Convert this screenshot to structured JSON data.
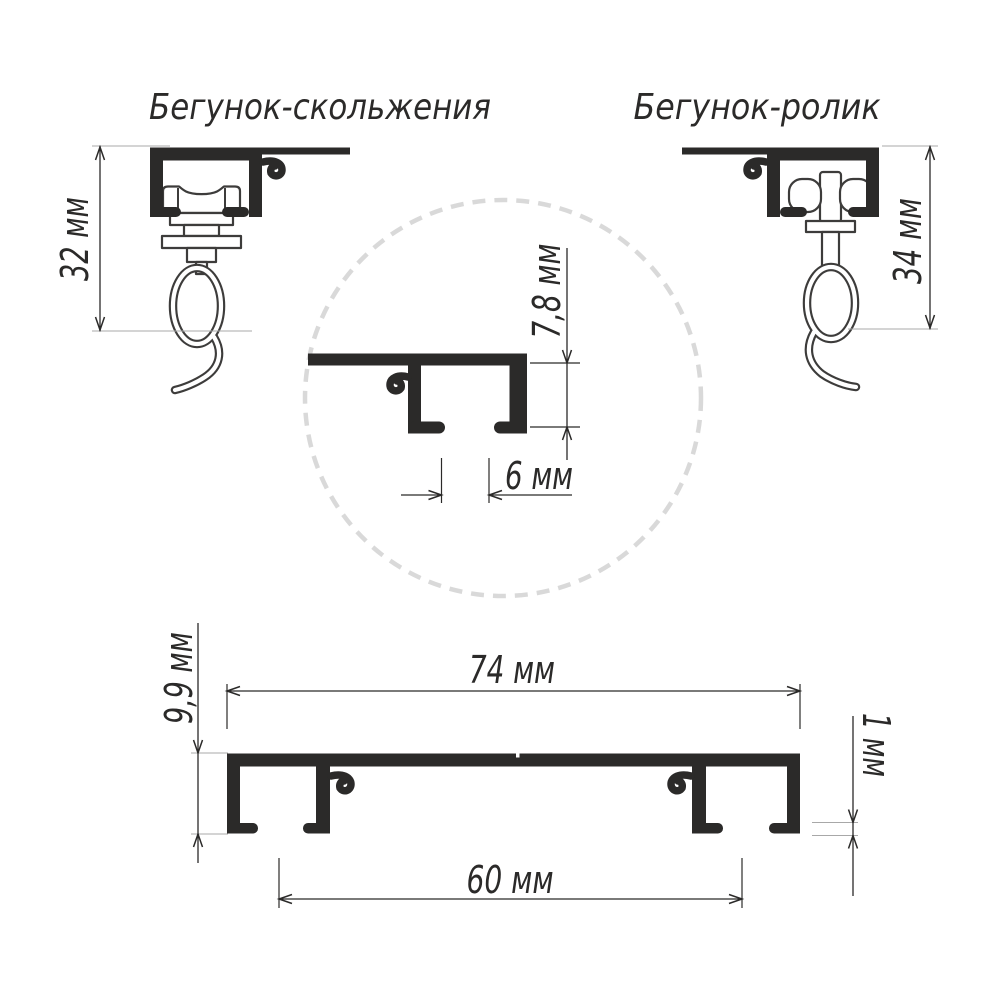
{
  "titles": {
    "left": "Бегунок-скольжения",
    "right": "Бегунок-ролик"
  },
  "dims": {
    "left_height": "32 мм",
    "right_height": "34 мм",
    "inner_height": "7,8 мм",
    "slot": "6 мм",
    "width": "74 мм",
    "height": "9,9 мм",
    "thickness": "1 мм",
    "spacing": "60 мм"
  },
  "colors": {
    "ink": "#2b2a29",
    "outline": "#3d3c3b",
    "dashed_circle": "#d9d9d9",
    "background": "#ffffff"
  }
}
